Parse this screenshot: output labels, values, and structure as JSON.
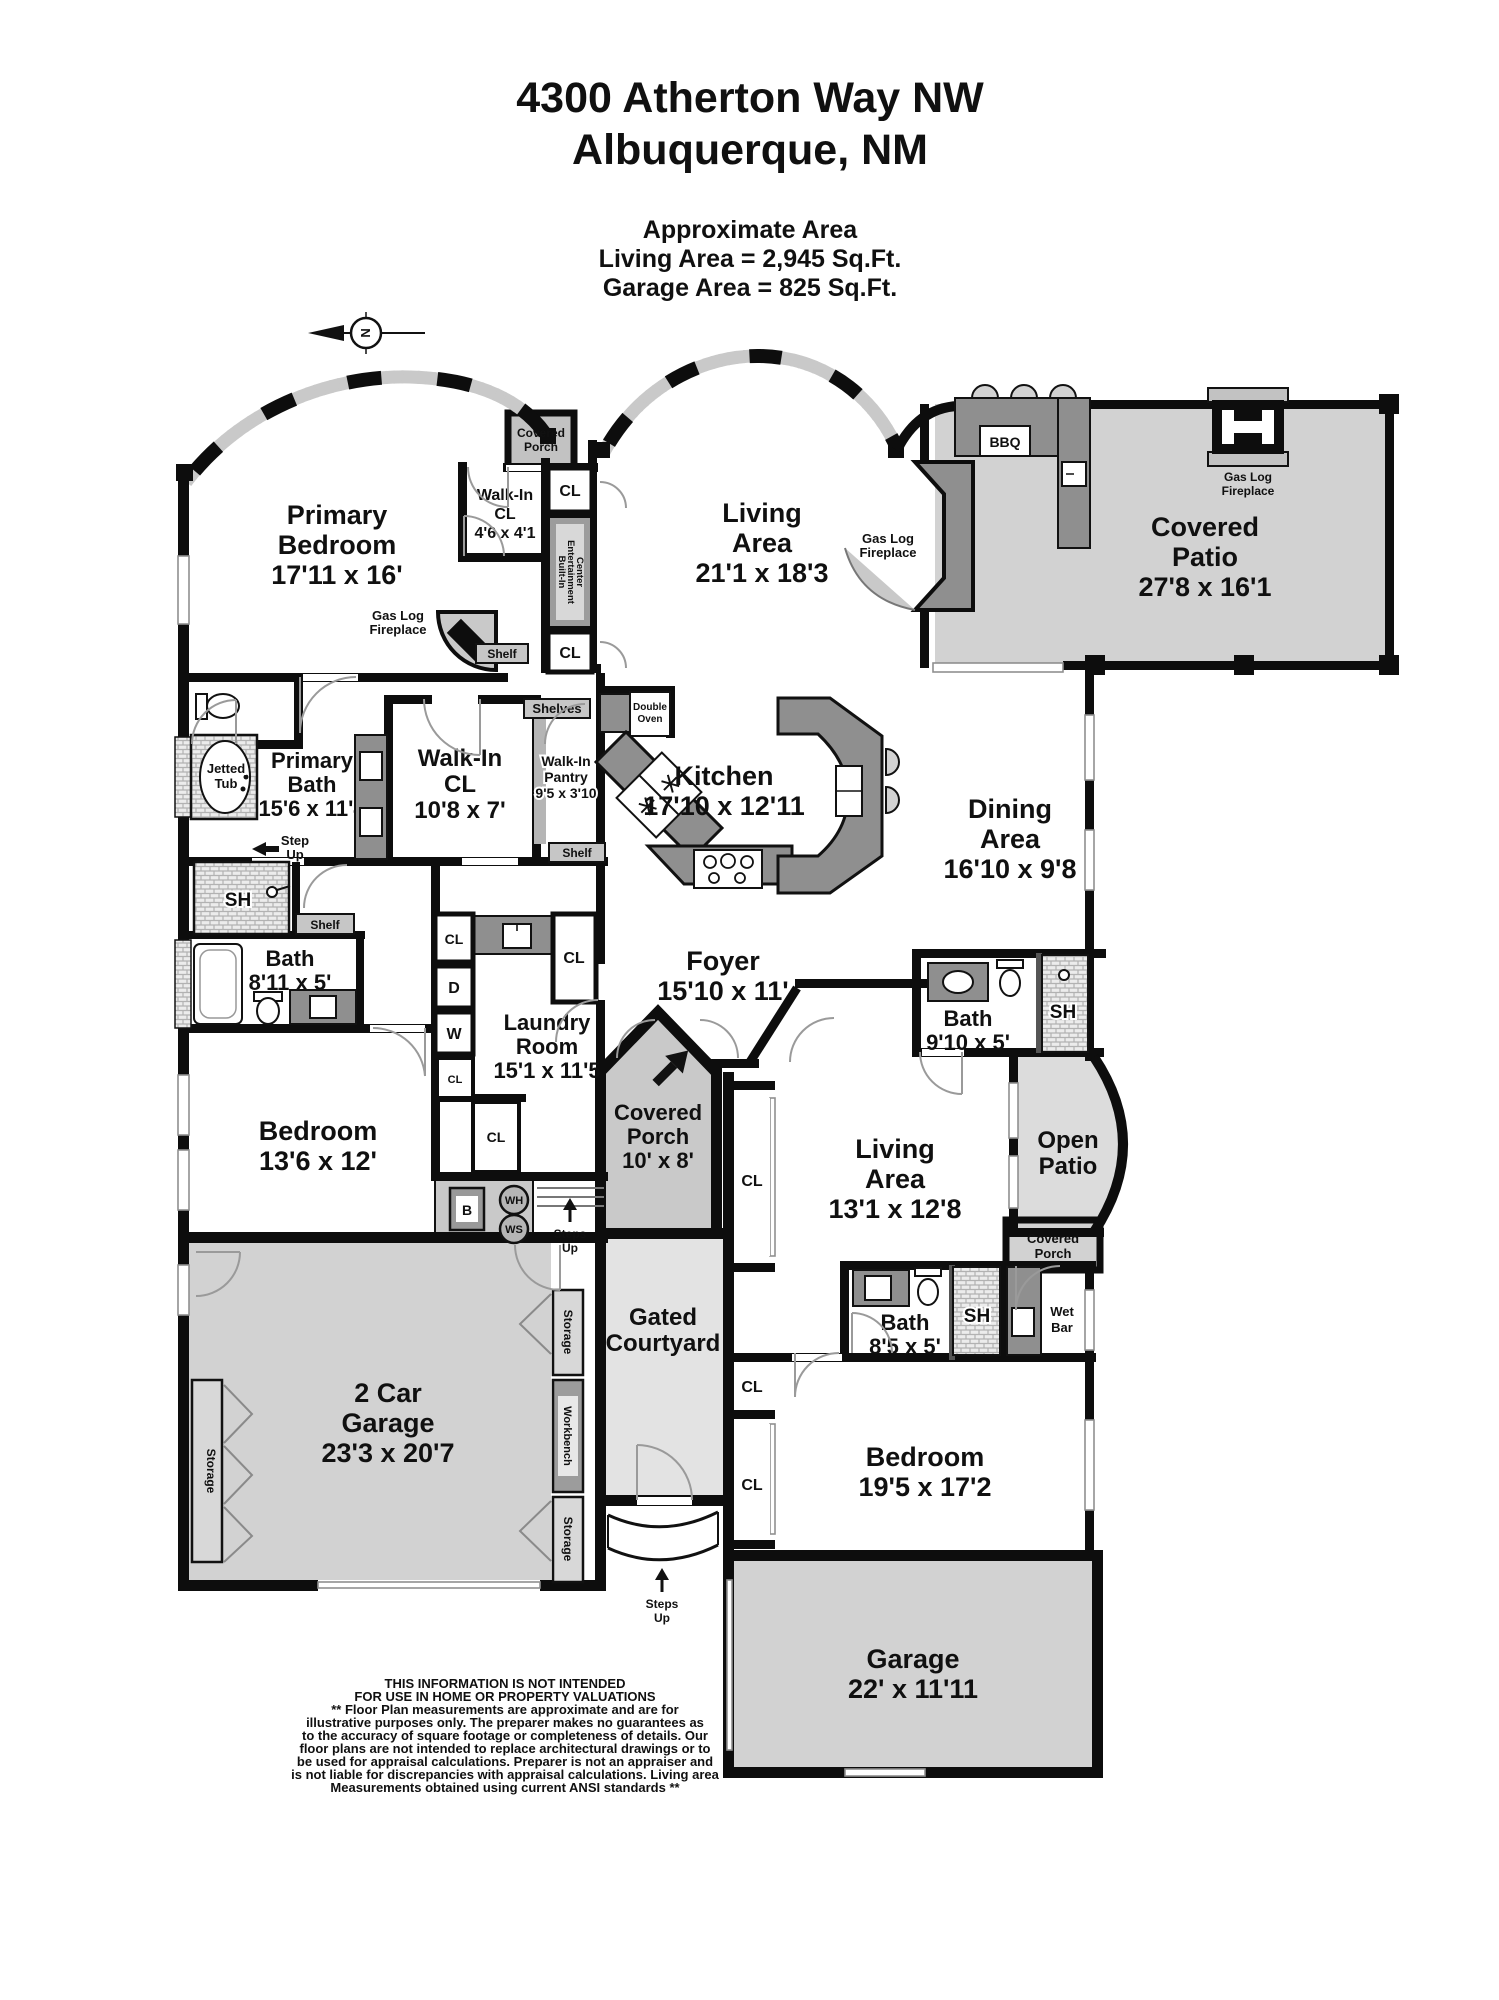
{
  "header": {
    "address_line1": "4300 Atherton Way NW",
    "address_line2": "Albuquerque, NM",
    "area_title": "Approximate Area",
    "living_area": "Living Area = 2,945 Sq.Ft.",
    "garage_area": "Garage Area = 825 Sq.Ft."
  },
  "compass": {
    "north": "N"
  },
  "rooms": {
    "primary_bedroom": {
      "lines": [
        "Primary",
        "Bedroom",
        "17'11 x 16'"
      ]
    },
    "living_area_main": {
      "lines": [
        "Living",
        "Area",
        "21'1 x 18'3"
      ]
    },
    "covered_patio": {
      "lines": [
        "Covered",
        "Patio",
        "27'8 x 16'1"
      ]
    },
    "dining_area": {
      "lines": [
        "Dining",
        "Area",
        "16'10 x 9'8"
      ]
    },
    "kitchen": {
      "lines": [
        "Kitchen",
        "17'10 x 12'11"
      ]
    },
    "walk_in_cl_small": {
      "lines": [
        "Walk-In",
        "CL",
        "4'6 x 4'1"
      ]
    },
    "primary_bath": {
      "lines": [
        "Primary",
        "Bath",
        "15'6 x 11'4"
      ]
    },
    "walk_in_cl": {
      "lines": [
        "Walk-In",
        "CL",
        "10'8 x 7'"
      ]
    },
    "walk_in_pantry": {
      "lines": [
        "Walk-In",
        "Pantry",
        "9'5 x 3'10"
      ]
    },
    "bath_middle": {
      "lines": [
        "Bath",
        "8'11 x 5'"
      ]
    },
    "foyer": {
      "lines": [
        "Foyer",
        "15'10 x 11'"
      ]
    },
    "laundry_room": {
      "lines": [
        "Laundry",
        "Room",
        "15'1 x 11'5"
      ]
    },
    "bedroom_left": {
      "lines": [
        "Bedroom",
        "13'6 x 12'"
      ]
    },
    "covered_porch_entry": {
      "lines": [
        "Covered",
        "Porch",
        "10' x 8'"
      ]
    },
    "living_area_casita": {
      "lines": [
        "Living",
        "Area",
        "13'1 x 12'8"
      ]
    },
    "bath_right": {
      "lines": [
        "Bath",
        "9'10 x 5'"
      ]
    },
    "open_patio": {
      "lines": [
        "Open",
        "Patio"
      ]
    },
    "bath_casita": {
      "lines": [
        "Bath",
        "8'5 x 5'"
      ]
    },
    "bedroom_casita": {
      "lines": [
        "Bedroom",
        "19'5 x 17'2"
      ]
    },
    "garage_2car": {
      "lines": [
        "2 Car",
        "Garage",
        "23'3 x 20'7"
      ]
    },
    "garage_small": {
      "lines": [
        "Garage",
        "22' x 11'11"
      ]
    },
    "gated_courtyard": {
      "lines": [
        "Gated",
        "Courtyard"
      ]
    }
  },
  "features": {
    "covered_porch": {
      "lines": [
        "Covered",
        "Porch"
      ]
    },
    "gas_log_fireplace": {
      "lines": [
        "Gas Log",
        "Fireplace"
      ]
    },
    "bbq": "BBQ",
    "double_oven": {
      "lines": [
        "Double",
        "Oven"
      ]
    },
    "shelves": "Shelves",
    "shelf": "Shelf",
    "jetted_tub": {
      "lines": [
        "Jetted",
        "Tub"
      ]
    },
    "step_up": {
      "lines": [
        "Step",
        "Up"
      ]
    },
    "steps_up": {
      "lines": [
        "Steps",
        "Up"
      ]
    },
    "shower": "SH",
    "closet": "CL",
    "dryer": "D",
    "washer": "W",
    "boiler": "B",
    "water_heater": "WH",
    "water_softener": "WS",
    "wet_bar": {
      "lines": [
        "Wet",
        "Bar"
      ]
    },
    "storage": "Storage",
    "workbench": "Workbench",
    "built_in": {
      "lines": [
        "Built-In",
        "Entertainment",
        "Center"
      ]
    }
  },
  "disclaimer": {
    "lines": [
      "THIS INFORMATION IS NOT INTENDED",
      "FOR USE IN HOME OR PROPERTY VALUATIONS",
      "** Floor Plan measurements are approximate and are for",
      "illustrative purposes only. The preparer makes no guarantees as",
      "to the accuracy of square footage or completeness of details. Our",
      "floor plans are not intended to replace architectural drawings or to",
      "be used for appraisal calculations. Preparer is not an appraiser and",
      "is not liable for discrepancies with appraisal calculations. Living area",
      "Measurements obtained using current ANSI standards **"
    ]
  }
}
